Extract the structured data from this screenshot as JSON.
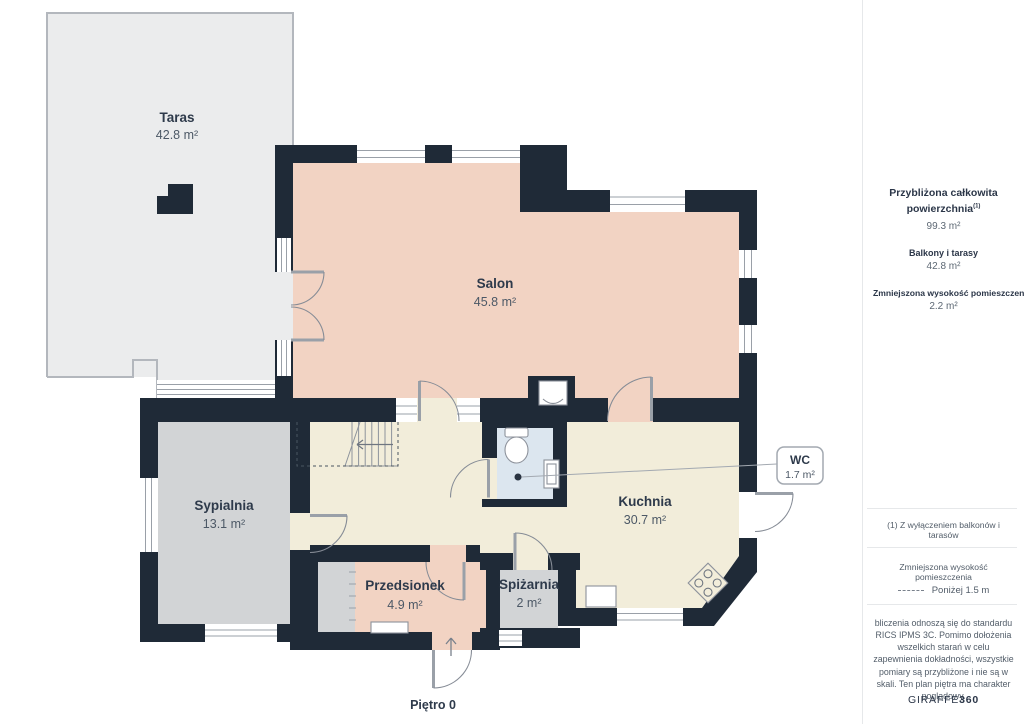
{
  "floor_plan": {
    "floor_label": "Piętro 0",
    "rooms": [
      {
        "name": "Taras",
        "area": "42.8 m²"
      },
      {
        "name": "Salon",
        "area": "45.8 m²"
      },
      {
        "name": "Sypialnia",
        "area": "13.1 m²"
      },
      {
        "name": "Kuchnia",
        "area": "30.7 m²"
      },
      {
        "name": "Przedsionek",
        "area": "4.9 m²"
      },
      {
        "name": "Spiżarnia",
        "area": "2 m²"
      },
      {
        "name": "WC",
        "area": "1.7 m²"
      }
    ]
  },
  "sidebar": {
    "total_area_label_line1": "Przybliżona całkowita",
    "total_area_label_line2": "powierzchnia",
    "total_area_footnote_marker": "(1)",
    "total_area_value": "99.3 m²",
    "balconies_label": "Balkony i tarasy",
    "balconies_value": "42.8 m²",
    "reduced_height_label": "Zmniejszona wysokość pomieszczenia",
    "reduced_height_value": "2.2 m²",
    "footnote": "(1) Z wyłączeniem balkonów i tarasów",
    "legend_heading": "Zmniejszona wysokość pomieszczenia",
    "legend_dashed_label": "Poniżej 1.5 m",
    "disclaimer": "bliczenia odnoszą się do standardu RICS IPMS 3C. Pomimo dołożenia wszelkich starań w celu zapewnienia dokładności, wszystkie pomiary są przybliżone i nie są w skali. Ten plan piętra ma charakter poglądowy.",
    "brand_name": "GIRAFFE",
    "brand_suffix": "360"
  },
  "colors": {
    "wall": "#1f2a37",
    "living_floor": "#f2d3c3",
    "kitchen_floor": "#f2edda",
    "gray_room_floor": "#d2d4d6",
    "terrace_floor": "#ebeced",
    "wc_floor": "#dce6ef",
    "line_gray": "#8d929b",
    "text_navy": "#2e3a4b"
  }
}
